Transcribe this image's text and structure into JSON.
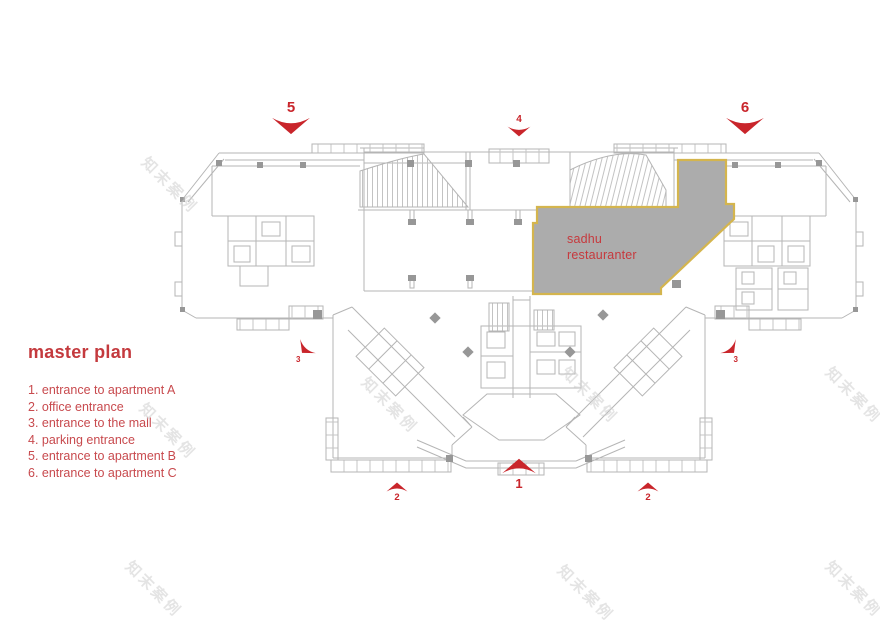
{
  "legend": {
    "title": "master plan",
    "items": [
      "1. entrance to apartment A",
      "2. office entrance",
      "3. entrance to the mall",
      "4. parking entrance",
      "5. entrance to apartment B",
      "6. entrance to apartment C"
    ]
  },
  "highlight": {
    "name_line1": "sadhu",
    "name_line2": "restauranter"
  },
  "markers": {
    "apartment_b": "5",
    "parking": "4",
    "apartment_c": "6",
    "mall_left": "3",
    "mall_right": "3",
    "office_left": "2",
    "main_entrance": "1",
    "office_right": "2"
  },
  "watermark": {
    "text": "知末案例"
  },
  "colors": {
    "accent_red": "#c43a3e",
    "marker_red": "#c9252b",
    "highlight_fill": "#acacac",
    "highlight_border": "#d4b54e",
    "plan_line": "#b5b5b5"
  }
}
